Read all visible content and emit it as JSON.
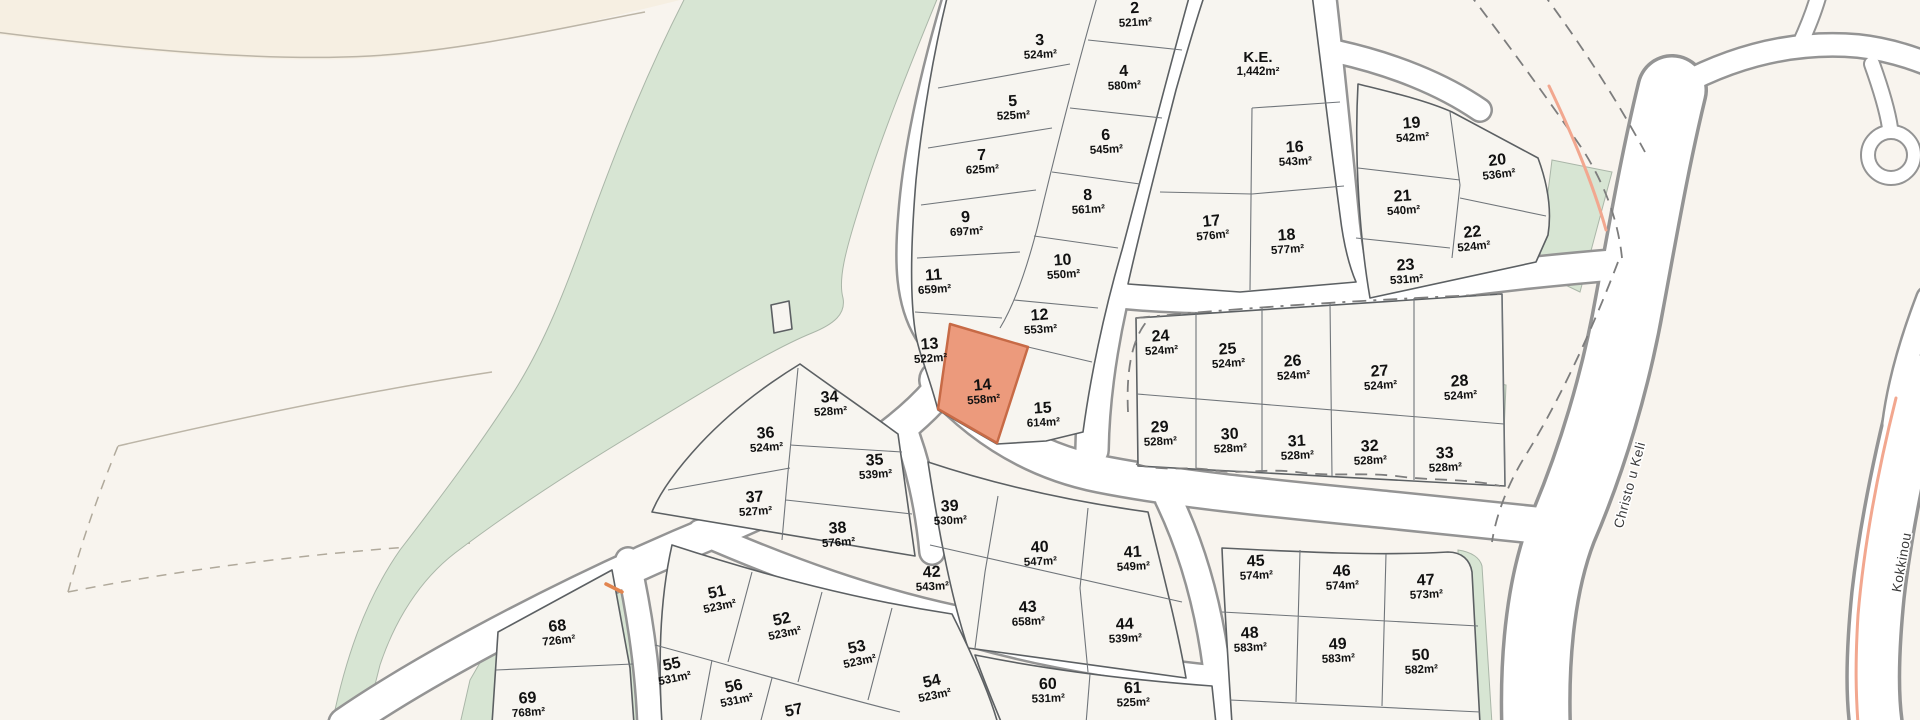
{
  "map": {
    "type": "land-parcel-subdivision-plan",
    "units": "m²",
    "highlighted_plot": "14",
    "highlighted_plot_area": "558m²"
  },
  "colors": {
    "background": "#f8f4ee",
    "background_upper_left": "#f6efe2",
    "green_area": "#d7e5d3",
    "plot_fill": "#f7f5f0",
    "plot_border": "#5c6063",
    "road_fill": "#ffffff",
    "road_casing": "#949494",
    "highlight_fill": "#ec9a7c",
    "highlight_border": "#c76a46",
    "dashed_line": "#7d7d7d",
    "accent_road_line": "#f2a78f",
    "label_color": "#111111",
    "street_label_color": "#3a3a3a"
  },
  "plots": [
    {
      "number": "2",
      "area": "521m²",
      "x": 1135,
      "y": 14,
      "rot": -3
    },
    {
      "number": "3",
      "area": "524m²",
      "x": 1040,
      "y": 46,
      "rot": -3
    },
    {
      "number": "4",
      "area": "580m²",
      "x": 1124,
      "y": 77,
      "rot": -3
    },
    {
      "number": "5",
      "area": "525m²",
      "x": 1013,
      "y": 107,
      "rot": -3
    },
    {
      "number": "6",
      "area": "545m²",
      "x": 1106,
      "y": 141,
      "rot": -3
    },
    {
      "number": "7",
      "area": "625m²",
      "x": 982,
      "y": 161,
      "rot": -3
    },
    {
      "number": "8",
      "area": "561m²",
      "x": 1088,
      "y": 201,
      "rot": -3
    },
    {
      "number": "9",
      "area": "697m²",
      "x": 966,
      "y": 223,
      "rot": -4
    },
    {
      "number": "10",
      "area": "550m²",
      "x": 1063,
      "y": 266,
      "rot": -4
    },
    {
      "number": "11",
      "area": "659m²",
      "x": 934,
      "y": 281,
      "rot": -4
    },
    {
      "number": "12",
      "area": "553m²",
      "x": 1040,
      "y": 321,
      "rot": -4
    },
    {
      "number": "13",
      "area": "522m²",
      "x": 930,
      "y": 350,
      "rot": -4
    },
    {
      "number": "14",
      "area": "558m²",
      "x": 983,
      "y": 391,
      "rot": -5,
      "highlighted": true
    },
    {
      "number": "15",
      "area": "614m²",
      "x": 1043,
      "y": 414,
      "rot": -3
    },
    {
      "number": "K.E.",
      "area": "1,442m²",
      "x": 1258,
      "y": 63,
      "rot": 0
    },
    {
      "number": "16",
      "area": "543m²",
      "x": 1295,
      "y": 153,
      "rot": -3
    },
    {
      "number": "17",
      "area": "576m²",
      "x": 1212,
      "y": 227,
      "rot": -6
    },
    {
      "number": "18",
      "area": "577m²",
      "x": 1287,
      "y": 241,
      "rot": -4
    },
    {
      "number": "19",
      "area": "542m²",
      "x": 1412,
      "y": 129,
      "rot": -4
    },
    {
      "number": "20",
      "area": "536m²",
      "x": 1498,
      "y": 166,
      "rot": -7
    },
    {
      "number": "21",
      "area": "540m²",
      "x": 1403,
      "y": 202,
      "rot": -4
    },
    {
      "number": "22",
      "area": "524m²",
      "x": 1473,
      "y": 238,
      "rot": -6
    },
    {
      "number": "23",
      "area": "531m²",
      "x": 1406,
      "y": 271,
      "rot": -4
    },
    {
      "number": "24",
      "area": "524m²",
      "x": 1161,
      "y": 342,
      "rot": -4
    },
    {
      "number": "25",
      "area": "524m²",
      "x": 1228,
      "y": 355,
      "rot": -4
    },
    {
      "number": "26",
      "area": "524m²",
      "x": 1293,
      "y": 367,
      "rot": -4
    },
    {
      "number": "27",
      "area": "524m²",
      "x": 1380,
      "y": 377,
      "rot": -4
    },
    {
      "number": "28",
      "area": "524m²",
      "x": 1460,
      "y": 387,
      "rot": -4
    },
    {
      "number": "29",
      "area": "528m²",
      "x": 1160,
      "y": 433,
      "rot": -3
    },
    {
      "number": "30",
      "area": "528m²",
      "x": 1230,
      "y": 440,
      "rot": -3
    },
    {
      "number": "31",
      "area": "528m²",
      "x": 1297,
      "y": 447,
      "rot": -3
    },
    {
      "number": "32",
      "area": "528m²",
      "x": 1370,
      "y": 452,
      "rot": -3
    },
    {
      "number": "33",
      "area": "528m²",
      "x": 1445,
      "y": 459,
      "rot": -3
    },
    {
      "number": "34",
      "area": "528m²",
      "x": 830,
      "y": 403,
      "rot": -4
    },
    {
      "number": "35",
      "area": "539m²",
      "x": 875,
      "y": 466,
      "rot": -4
    },
    {
      "number": "36",
      "area": "524m²",
      "x": 766,
      "y": 439,
      "rot": -4
    },
    {
      "number": "37",
      "area": "527m²",
      "x": 755,
      "y": 503,
      "rot": -4
    },
    {
      "number": "38",
      "area": "576m²",
      "x": 838,
      "y": 534,
      "rot": -4
    },
    {
      "number": "39",
      "area": "530m²",
      "x": 950,
      "y": 512,
      "rot": -3
    },
    {
      "number": "40",
      "area": "547m²",
      "x": 1040,
      "y": 553,
      "rot": -3
    },
    {
      "number": "41",
      "area": "549m²",
      "x": 1133,
      "y": 558,
      "rot": -3
    },
    {
      "number": "42",
      "area": "543m²",
      "x": 932,
      "y": 578,
      "rot": -3
    },
    {
      "number": "43",
      "area": "658m²",
      "x": 1028,
      "y": 613,
      "rot": -3
    },
    {
      "number": "44",
      "area": "539m²",
      "x": 1125,
      "y": 630,
      "rot": -3
    },
    {
      "number": "45",
      "area": "574m²",
      "x": 1256,
      "y": 567,
      "rot": -3
    },
    {
      "number": "46",
      "area": "574m²",
      "x": 1342,
      "y": 577,
      "rot": -3
    },
    {
      "number": "47",
      "area": "573m²",
      "x": 1426,
      "y": 586,
      "rot": -3
    },
    {
      "number": "48",
      "area": "583m²",
      "x": 1250,
      "y": 639,
      "rot": -3
    },
    {
      "number": "49",
      "area": "583m²",
      "x": 1338,
      "y": 650,
      "rot": -3
    },
    {
      "number": "50",
      "area": "582m²",
      "x": 1421,
      "y": 661,
      "rot": -3
    },
    {
      "number": "51",
      "area": "523m²",
      "x": 718,
      "y": 598,
      "rot": -12
    },
    {
      "number": "52",
      "area": "523m²",
      "x": 783,
      "y": 625,
      "rot": -12
    },
    {
      "number": "53",
      "area": "523m²",
      "x": 858,
      "y": 653,
      "rot": -12
    },
    {
      "number": "54",
      "area": "523m²",
      "x": 933,
      "y": 687,
      "rot": -12
    },
    {
      "number": "55",
      "area": "531m²",
      "x": 673,
      "y": 670,
      "rot": -12
    },
    {
      "number": "56",
      "area": "531m²",
      "x": 735,
      "y": 692,
      "rot": -12
    },
    {
      "number": "57",
      "area": "",
      "x": 795,
      "y": 716,
      "rot": -12
    },
    {
      "number": "60",
      "area": "531m²",
      "x": 1048,
      "y": 690,
      "rot": -2
    },
    {
      "number": "61",
      "area": "525m²",
      "x": 1133,
      "y": 694,
      "rot": -2
    },
    {
      "number": "68",
      "area": "726m²",
      "x": 558,
      "y": 632,
      "rot": -6
    },
    {
      "number": "69",
      "area": "768m²",
      "x": 528,
      "y": 704,
      "rot": -4
    }
  ],
  "streets": [
    {
      "name": "Christo u Keli",
      "x": 1634,
      "y": 486,
      "rot": -75
    },
    {
      "name": "Kokkinou",
      "x": 1906,
      "y": 563,
      "rot": -80
    }
  ]
}
